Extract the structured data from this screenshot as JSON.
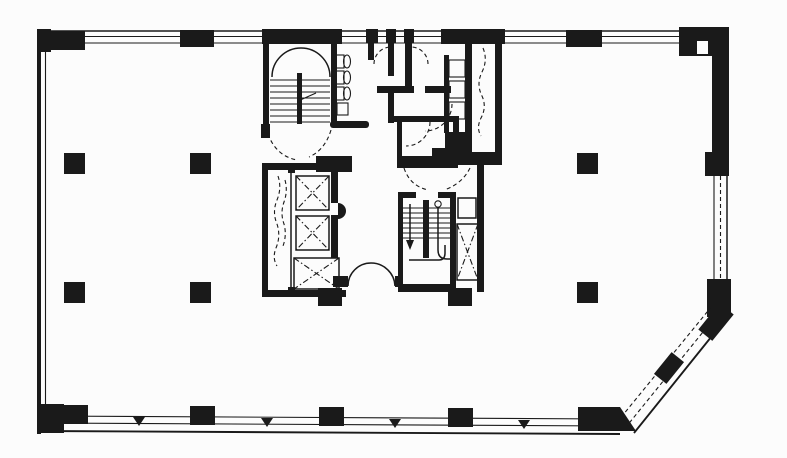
{
  "document": {
    "kind": "architectural floor plan",
    "description": "Black-and-white typical office tower floor plan: open floor with interior column grid, central service core (two stairwells, elevator bank, restrooms, shafts), perimeter window walls and a chamfered bottom-right corner"
  },
  "colors": {
    "ink": "#1a1a1a",
    "paper": "#fcfcfc"
  },
  "inventory": {
    "stairwells": 2,
    "elevator_cars": 3,
    "interior_columns": 6,
    "restroom_fixtures": 7,
    "double_doors": 1,
    "vent_shafts": 3,
    "chamfered_corner": "bottom-right",
    "window_walls": [
      "top",
      "bottom",
      "right-lower",
      "chamfer"
    ]
  }
}
